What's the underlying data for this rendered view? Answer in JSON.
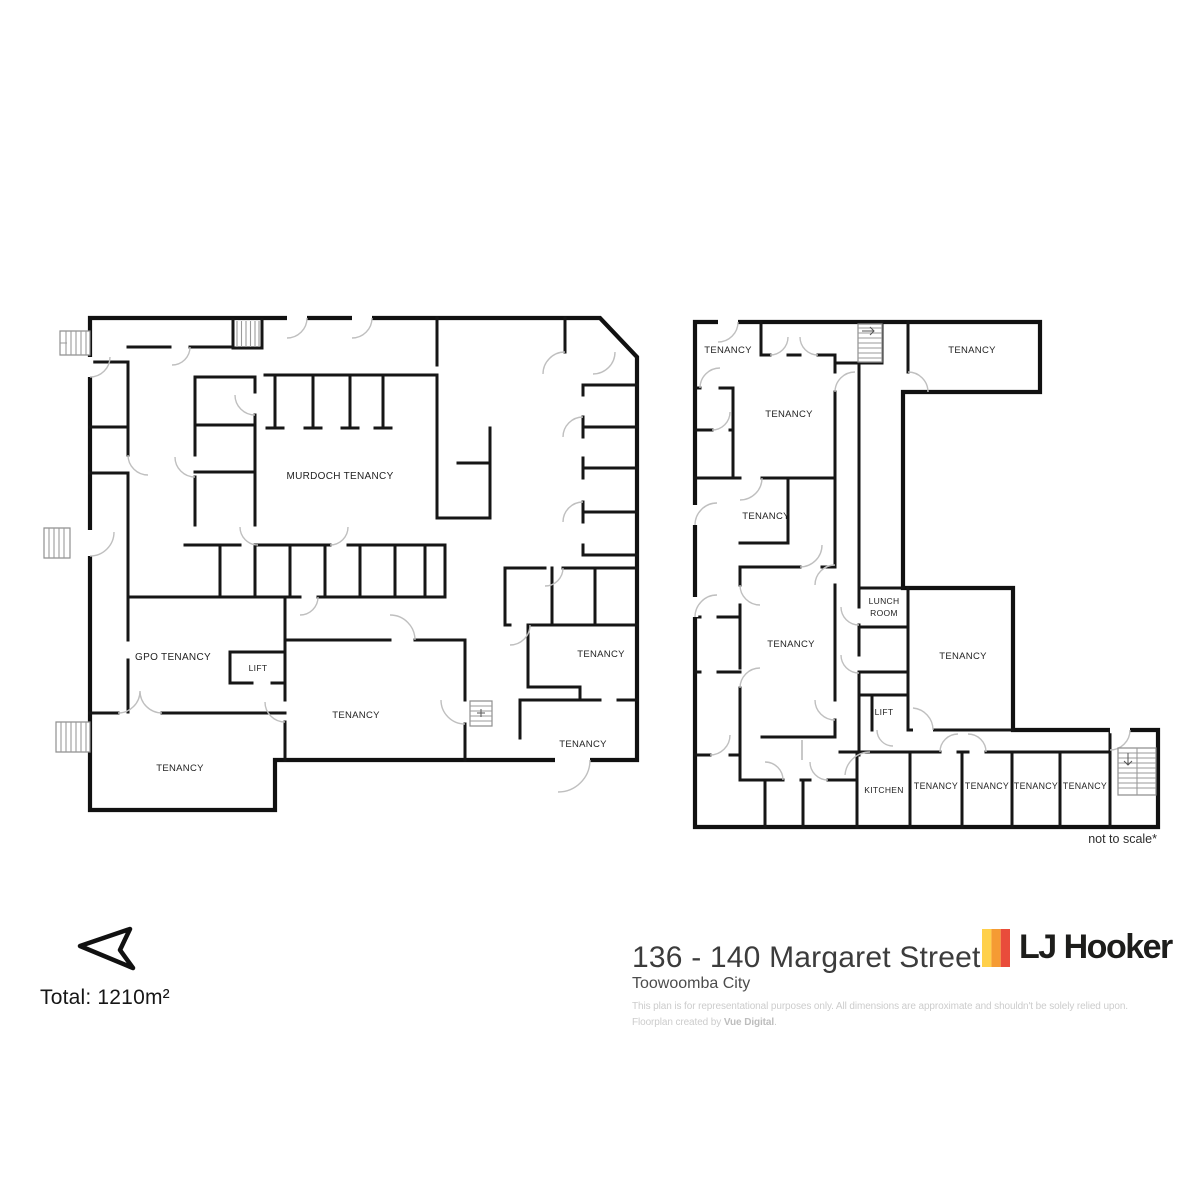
{
  "plans": {
    "left": {
      "labels": [
        {
          "text": "MURDOCH TENANCY"
        },
        {
          "text": "GPO TENANCY"
        },
        {
          "text": "LIFT"
        },
        {
          "text": "TENANCY"
        },
        {
          "text": "TENANCY"
        },
        {
          "text": "TENANCY"
        },
        {
          "text": "TENANCY"
        }
      ]
    },
    "right": {
      "labels": [
        {
          "text": "TENANCY"
        },
        {
          "text": "TENANCY"
        },
        {
          "text": "TENANCY"
        },
        {
          "text": "TENANCY"
        },
        {
          "text": "TENANCY"
        },
        {
          "text": "TENANCY"
        },
        {
          "text": "LIFT"
        },
        {
          "text": "KITCHEN"
        },
        {
          "text": "TENANCY"
        },
        {
          "text": "TENANCY"
        },
        {
          "text": "TENANCY"
        },
        {
          "text": "TENANCY"
        }
      ],
      "lunch_room": {
        "line1": "LUNCH",
        "line2": "ROOM"
      }
    },
    "scale_note": "not to scale*"
  },
  "footer": {
    "total_area": "Total: 1210m²",
    "address": {
      "title": "136 - 140 Margaret Street",
      "subtitle": "Toowoomba City"
    },
    "disclaimer": {
      "line1": "This plan is for representational purposes only. All dimensions are approximate and shouldn't be solely relied upon.",
      "credit_prefix": "Floorplan created by ",
      "credit_brand": "Vue Digital",
      "credit_suffix": "."
    },
    "logo": {
      "wordmark": "LJ Hooker",
      "stripes": [
        "#FFD04A",
        "#F59B33",
        "#E94C3B"
      ]
    },
    "icons": {
      "north_arrow": "north-arrow",
      "stairs": "stairs"
    }
  }
}
